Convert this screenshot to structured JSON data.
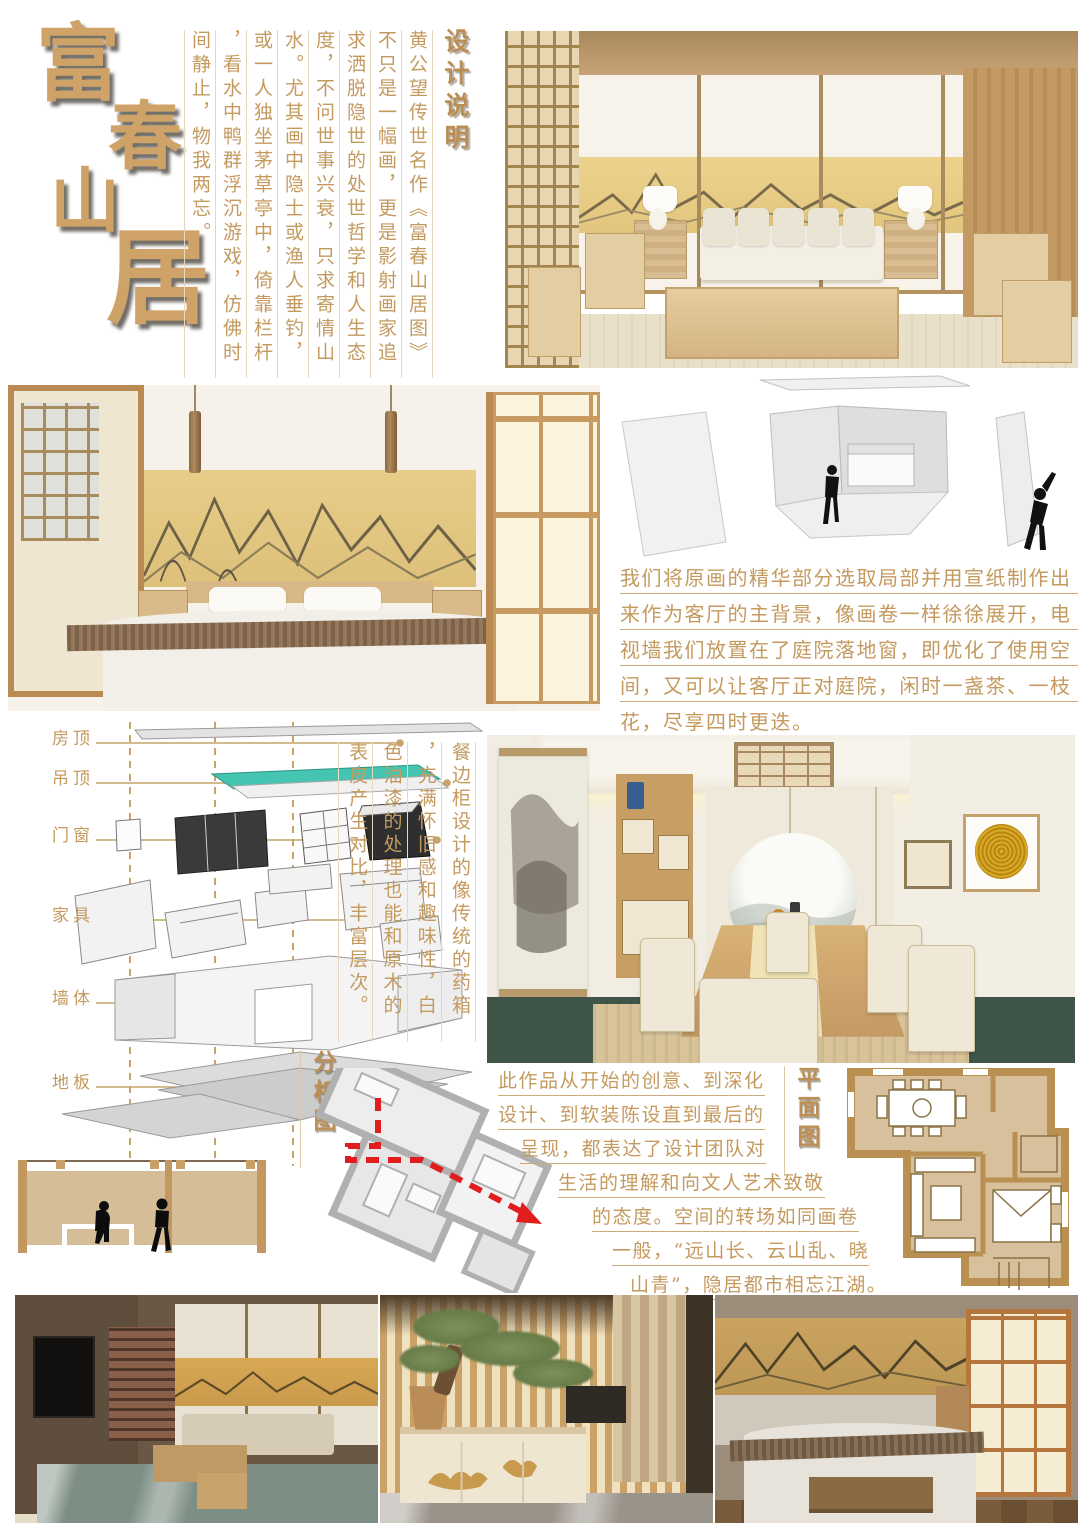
{
  "title": {
    "chars": [
      "富",
      "春",
      "山",
      "居"
    ],
    "color": "#cfa368"
  },
  "design_notes": {
    "heading": "设计说明",
    "columns": [
      "黄公望传世名作《富春山居图》",
      "不只是一幅画，更是影射画家追",
      "求洒脱隐世的处世哲学和人生态",
      "度，不问世事兴衰，只求寄情山",
      "水。尤其画中隐士或渔人垂钓，",
      "或一人独坐茅草亭中，倚靠栏杆",
      "，看水中鸭群浮沉游戏，仿佛时",
      "间静止，物我两忘。"
    ]
  },
  "living_paragraph": {
    "lines": [
      "我们将原画的精华部分选取局部并用宣纸制作出",
      "来作为客厅的主背景，像画卷一样徐徐展开，电",
      "视墙我们放置在了庭院落地窗，即优化了使用空",
      "间，又可以让客厅正对庭院，闲时一盏茶、一枝",
      "花，尽享四时更迭。"
    ]
  },
  "dining_note_columns": [
    "餐边柜设计的像传统的药箱",
    "，充满怀旧感和趣味性，白",
    "色油漆的处理也能和原木的",
    "表皮产生对比，丰富层次。"
  ],
  "exploded": {
    "labels": [
      "房顶",
      "吊顶",
      "门窗",
      "家具",
      "墙体",
      "地板"
    ]
  },
  "analysis_label": "分析图",
  "plan_label": "平面图",
  "closing_paragraph": {
    "lines": [
      "此作品从开始的创意、到深化",
      "设计、到软装陈设直到最后的",
      "呈现，都表达了设计团队对",
      "生活的理解和向文人艺术致敬",
      "的态度。空间的转场如同画卷",
      "一般，“远山长、云山乱、晓",
      "山青”，隐居都市相忘江湖。"
    ]
  },
  "colors": {
    "text_gold": "#c49a5f",
    "mural_gold": "#e3c67e",
    "ceiling_teal": "#45c4b2",
    "plan_room_tan": "#d8c09c",
    "plan_wall_tan": "#b98f52",
    "route_arrow_red": "#e11d1d"
  }
}
